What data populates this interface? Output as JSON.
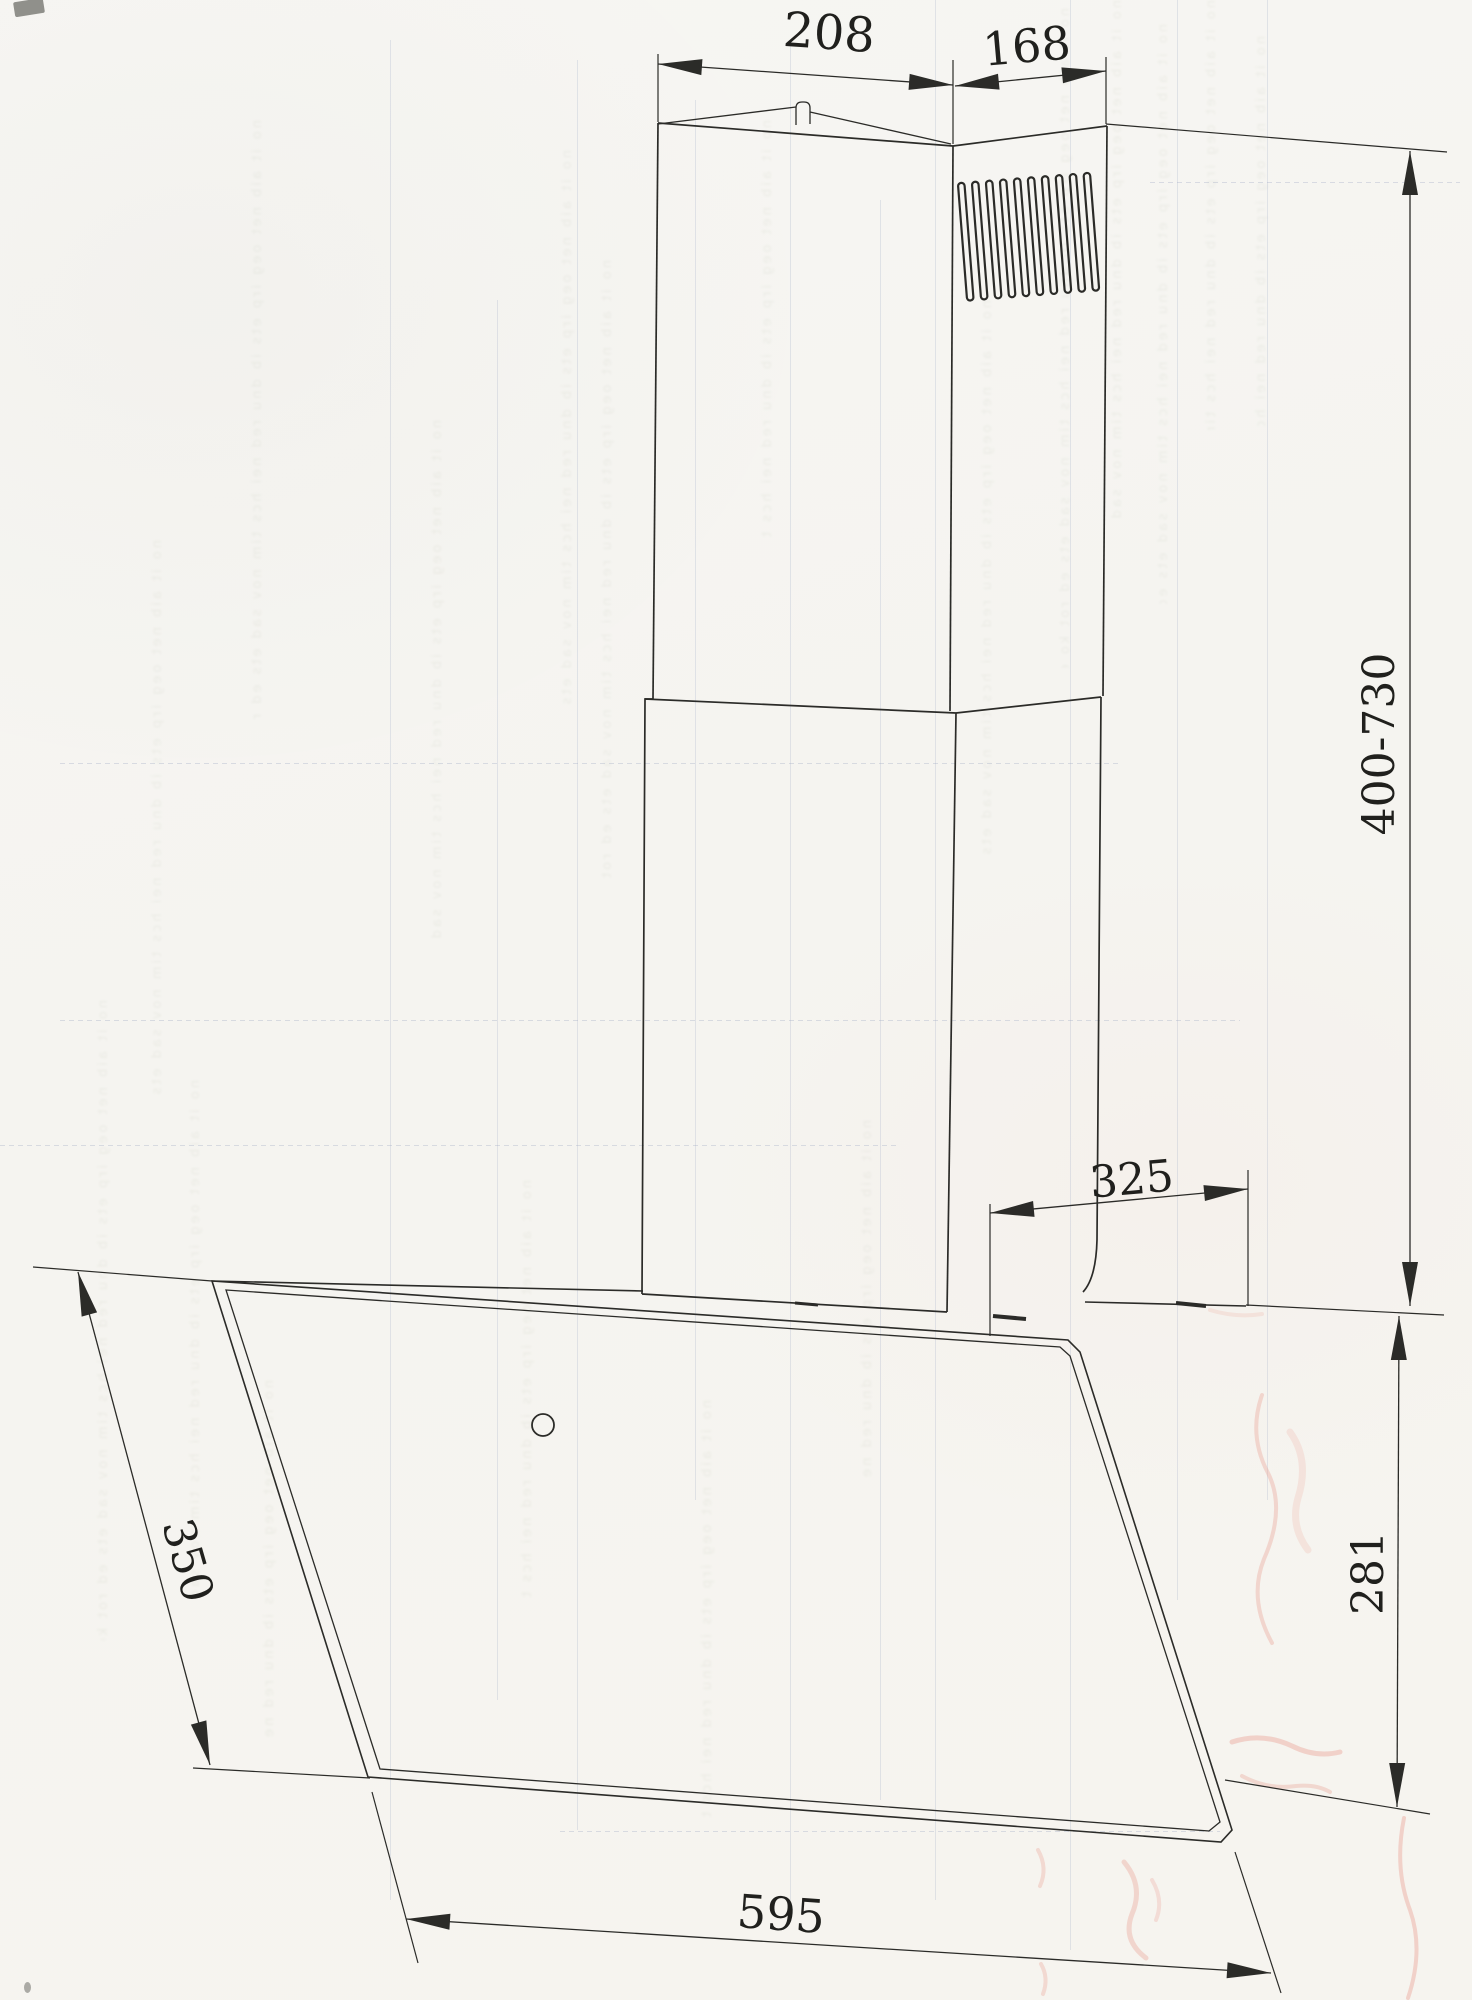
{
  "drawing": {
    "kind": "range-hood installation dimension drawing (scanned page)",
    "dimensions": {
      "front_width": "208",
      "side_width": "168",
      "chimney_height": "400-730",
      "chimney_depth": "325",
      "body_height": "281",
      "glass_edge": "350",
      "hood_width": "595"
    }
  },
  "background": {
    "bleed_texture": "no it aib net oeg irp ets ib dnu red nei hcs tim nov sad ets ed rot ko eb nie tlu ahc sni thc ir eid gnu tie lna noi tall ats ni red neb ahc su eid er hi gnu nn aps slie tre ll ets reh hcr ud gnu tfu lba eiw hcs ua gnu gid ah cse bne d"
  },
  "ink_marks": {
    "color_pink": "#eba79c",
    "line_color": "#2b2b28"
  }
}
